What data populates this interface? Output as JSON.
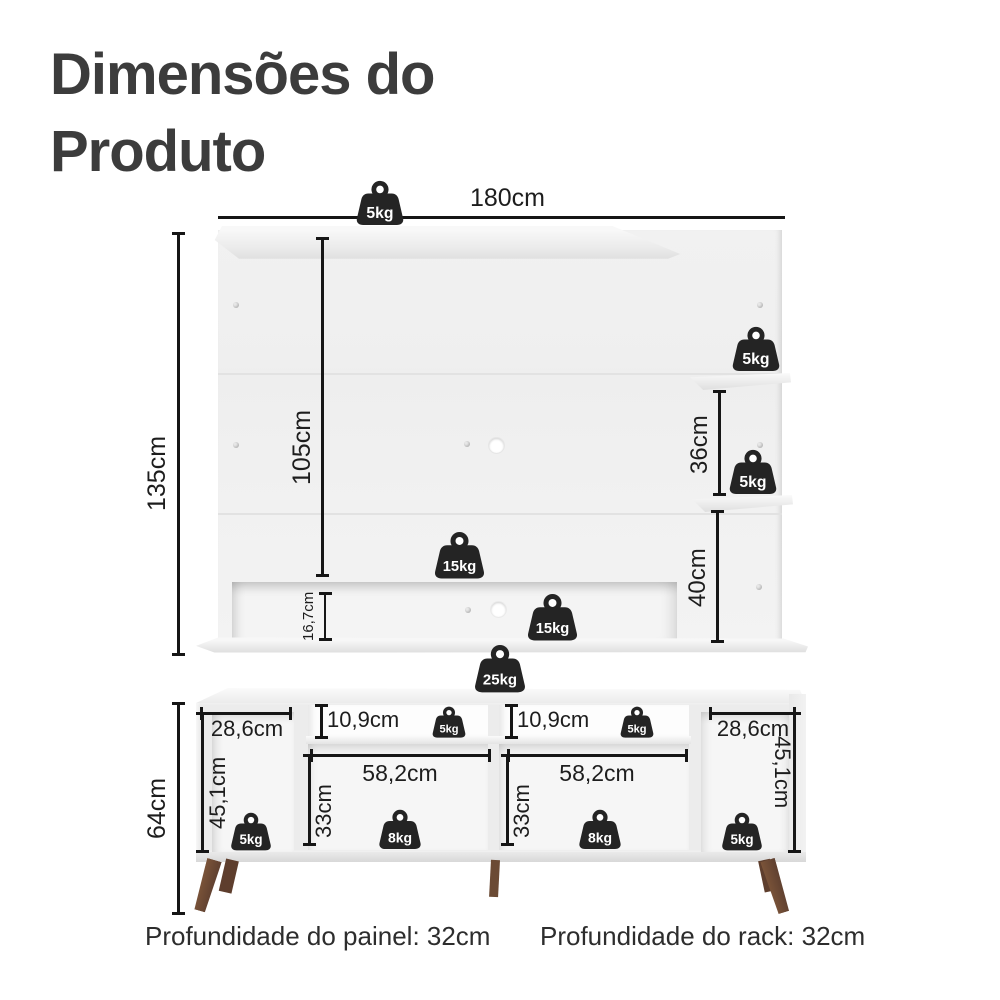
{
  "title": {
    "line1": "Dimensões do",
    "line2": "Produto"
  },
  "panel": {
    "width": "180cm",
    "height": "135cm",
    "inner_height": "105cm",
    "shelf_gap": "36cm",
    "below_shelf": "40cm",
    "niche_height": "16,7cm"
  },
  "rack": {
    "height": "64cm",
    "left_width": "28,6cm",
    "left_height": "45,1cm",
    "top_niche_left": "10,9cm",
    "top_niche_right": "10,9cm",
    "mid_width_left": "58,2cm",
    "mid_width_right": "58,2cm",
    "mid_height_left": "33cm",
    "mid_height_right": "33cm",
    "right_width": "28,6cm",
    "right_height": "45,1cm"
  },
  "weights": [
    {
      "id": "panel-top",
      "label": "5kg"
    },
    {
      "id": "shelf-upper",
      "label": "5kg"
    },
    {
      "id": "shelf-lower",
      "label": "5kg"
    },
    {
      "id": "panel-niche-top",
      "label": "15kg"
    },
    {
      "id": "panel-niche-in",
      "label": "15kg"
    },
    {
      "id": "rack-top",
      "label": "25kg"
    },
    {
      "id": "rack-niche-left",
      "label": "5kg"
    },
    {
      "id": "rack-niche-right",
      "label": "5kg"
    },
    {
      "id": "rack-left",
      "label": "5kg"
    },
    {
      "id": "rack-mid-left",
      "label": "8kg"
    },
    {
      "id": "rack-mid-right",
      "label": "8kg"
    },
    {
      "id": "rack-right",
      "label": "5kg"
    }
  ],
  "footer": {
    "panel_depth": "Profundidade do painel: 32cm",
    "rack_depth": "Profundidade do rack: 32cm"
  },
  "colors": {
    "line": "#161616",
    "dimension_text": "#1d1d1d",
    "title_text": "#3c3c3c",
    "weight_badge": "#242424",
    "leg_wood": "#6e4a36"
  }
}
